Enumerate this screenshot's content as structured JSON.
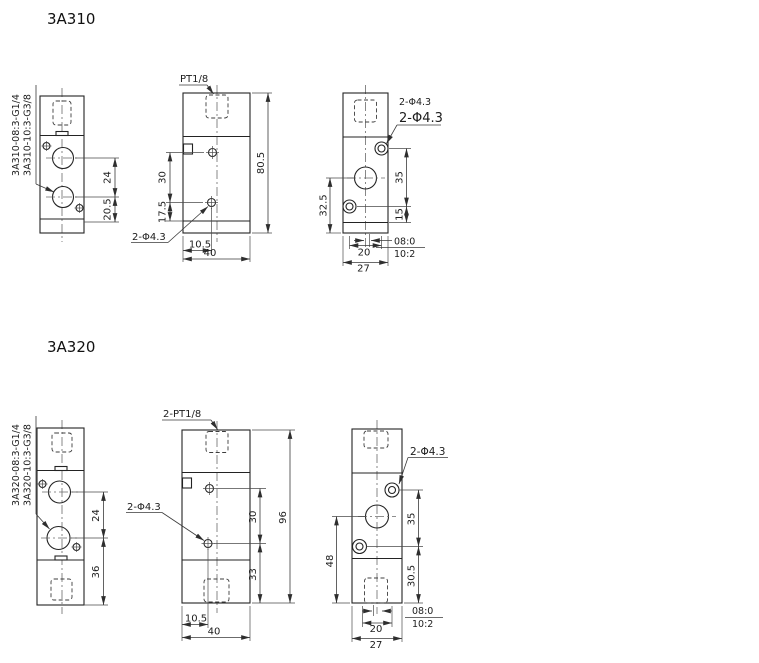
{
  "v310": {
    "title": "3A310",
    "model_g14": "3A310-08:3-G1/4",
    "model_g38": "3A310-10:3-G3/8",
    "port": "PT1/8",
    "hole": "2-Φ4.3",
    "hole_side_a": "2-Φ4.3",
    "hole_side_b": "2-Φ4.3",
    "d24": "24",
    "d20_5": "20.5",
    "d30": "30",
    "d17_5": "17.5",
    "d10_5": "10.5",
    "d40": "40",
    "d80_5": "80.5",
    "d35": "35",
    "d15": "15",
    "d32_5": "32.5",
    "d20": "20",
    "d27": "27",
    "off08": "08:0",
    "off10": "10:2"
  },
  "v320": {
    "title": "3A320",
    "model_g14": "3A320-08:3-G1/4",
    "model_g38": "3A320-10:3-G3/8",
    "port": "2-PT1/8",
    "hole": "2-Φ4.3",
    "hole_side": "2-Φ4.3",
    "d24": "24",
    "d36": "36",
    "d30": "30",
    "d33": "33",
    "d96": "96",
    "d10_5": "10.5",
    "d40": "40",
    "d35": "35",
    "d30_5": "30.5",
    "d48": "48",
    "d20": "20",
    "d27": "27",
    "off08": "08:0",
    "off10": "10:2"
  }
}
